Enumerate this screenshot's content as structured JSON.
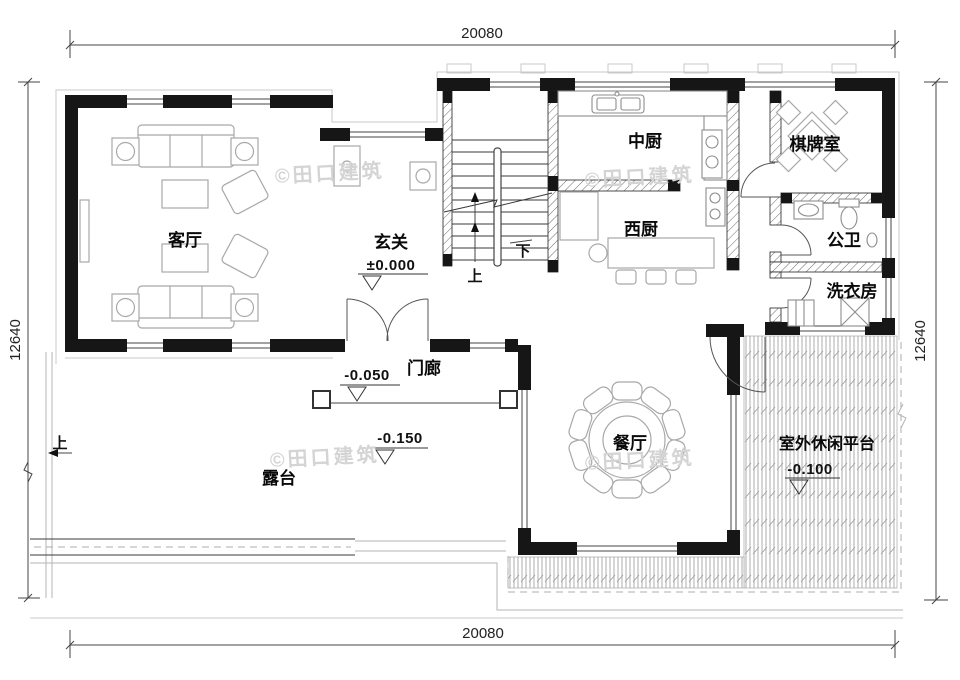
{
  "drawing": {
    "type": "floor-plan",
    "dimensions": {
      "top": "20080",
      "bottom": "20080",
      "left": "12640",
      "right": "12640"
    },
    "rooms": {
      "living": {
        "label": "客厅"
      },
      "foyer": {
        "label": "玄关",
        "level": "±0.000"
      },
      "kitchen_cn": {
        "label": "中厨"
      },
      "kitchen_w": {
        "label": "西厨"
      },
      "game": {
        "label": "棋牌室"
      },
      "wc": {
        "label": "公卫"
      },
      "laundry": {
        "label": "洗衣房"
      },
      "porch": {
        "label": "门廊",
        "level": "-0.050"
      },
      "terrace": {
        "label": "露台",
        "level": "-0.150"
      },
      "dining": {
        "label": "餐厅"
      },
      "platform": {
        "label": "室外休闲平台",
        "level": "-0.100"
      }
    },
    "stairs": {
      "up": "上",
      "down": "下"
    },
    "site": {
      "entry_step": "上"
    },
    "watermark": {
      "text": "©田口建筑"
    },
    "colors": {
      "wall": "#161616",
      "furniture": "#a8a8a8",
      "watermark": "#d4d4d4"
    }
  }
}
